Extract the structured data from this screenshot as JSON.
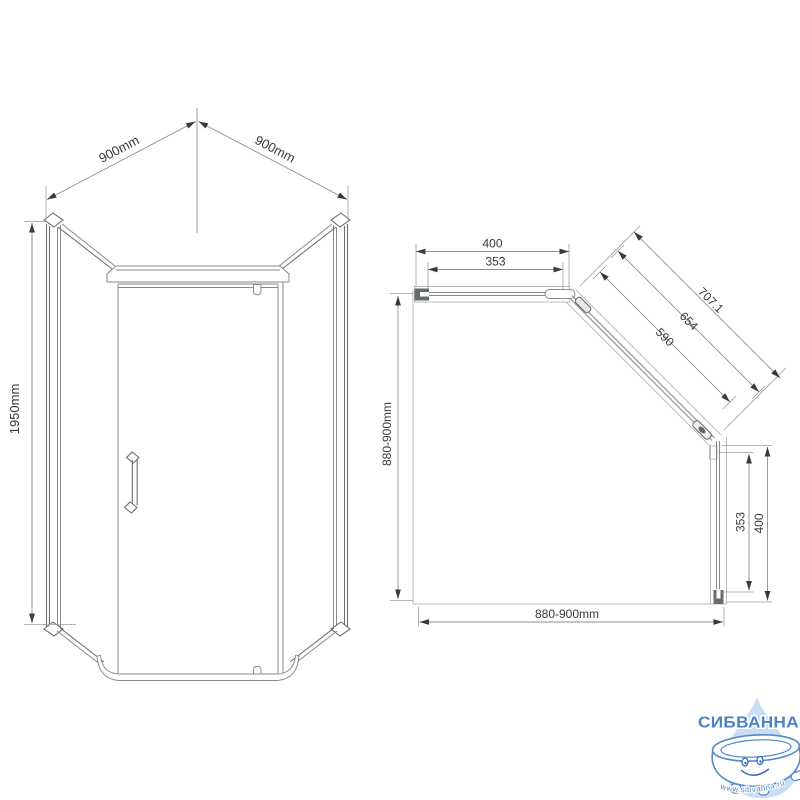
{
  "canvas": {
    "background": "#ffffff",
    "object_line_color": "#6e6e6e",
    "thin_line_color": "#b9bdbd",
    "dimension_text_color": "#383838"
  },
  "front_view": {
    "dims": {
      "top_left_width": "900mm",
      "top_right_width": "900mm",
      "height": "1950mm"
    }
  },
  "plan_view": {
    "dims": {
      "top_overall": "400",
      "top_glass": "353",
      "diagonal_overall": "707.1",
      "diagonal_mid": "654",
      "diagonal_glass": "590",
      "left_depth": "880-900mm",
      "bottom_width": "880-900mm",
      "right_glass": "353",
      "right_overall": "400"
    }
  },
  "logo": {
    "brand": "СИБВАННА",
    "url": "www.sibvanna.ru",
    "drop_color": "#c7def4",
    "outline_color": "#4a82c4"
  }
}
